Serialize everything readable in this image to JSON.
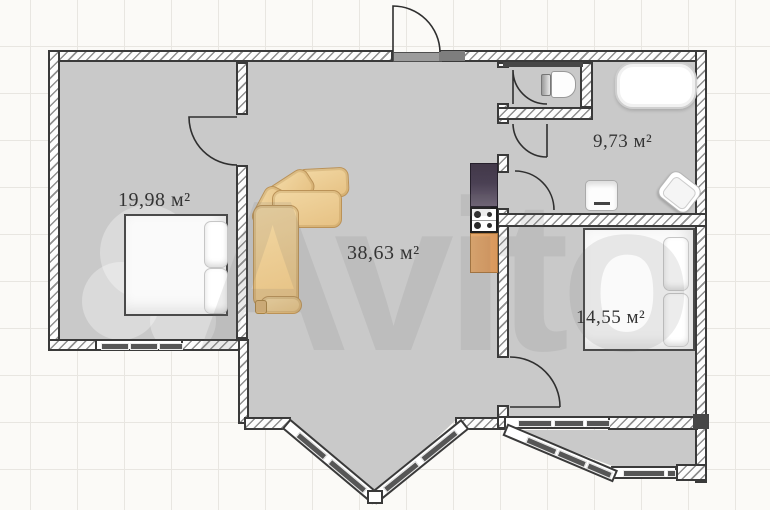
{
  "watermark_text": "Avito",
  "rooms": [
    {
      "id": "bedroom-left",
      "area_label": "19,98 м²",
      "area_m2": 19.98
    },
    {
      "id": "living-room-kitchen",
      "area_label": "38,63 м²",
      "area_m2": 38.63
    },
    {
      "id": "bathroom",
      "area_label": "9,73 м²",
      "area_m2": 9.73
    },
    {
      "id": "bedroom-right",
      "area_label": "14,55 м²",
      "area_m2": 14.55
    }
  ],
  "furniture": [
    "double-bed",
    "corner-sofa",
    "fridge",
    "stove",
    "kitchen-counter",
    "bathtub",
    "toilet",
    "washing-machine",
    "sink",
    "double-bed"
  ],
  "colors": {
    "wall_dark": "#3a3a3a",
    "floor_gray": "#c9c9c9",
    "sofa_tan": "#eccb93",
    "counter_wood": "#dfa266",
    "fridge_purple": "#4c4155",
    "window_bar": "#565656",
    "background": "#fbfaf7",
    "grid_line": "#e8e6e1",
    "label_text": "#343434"
  }
}
